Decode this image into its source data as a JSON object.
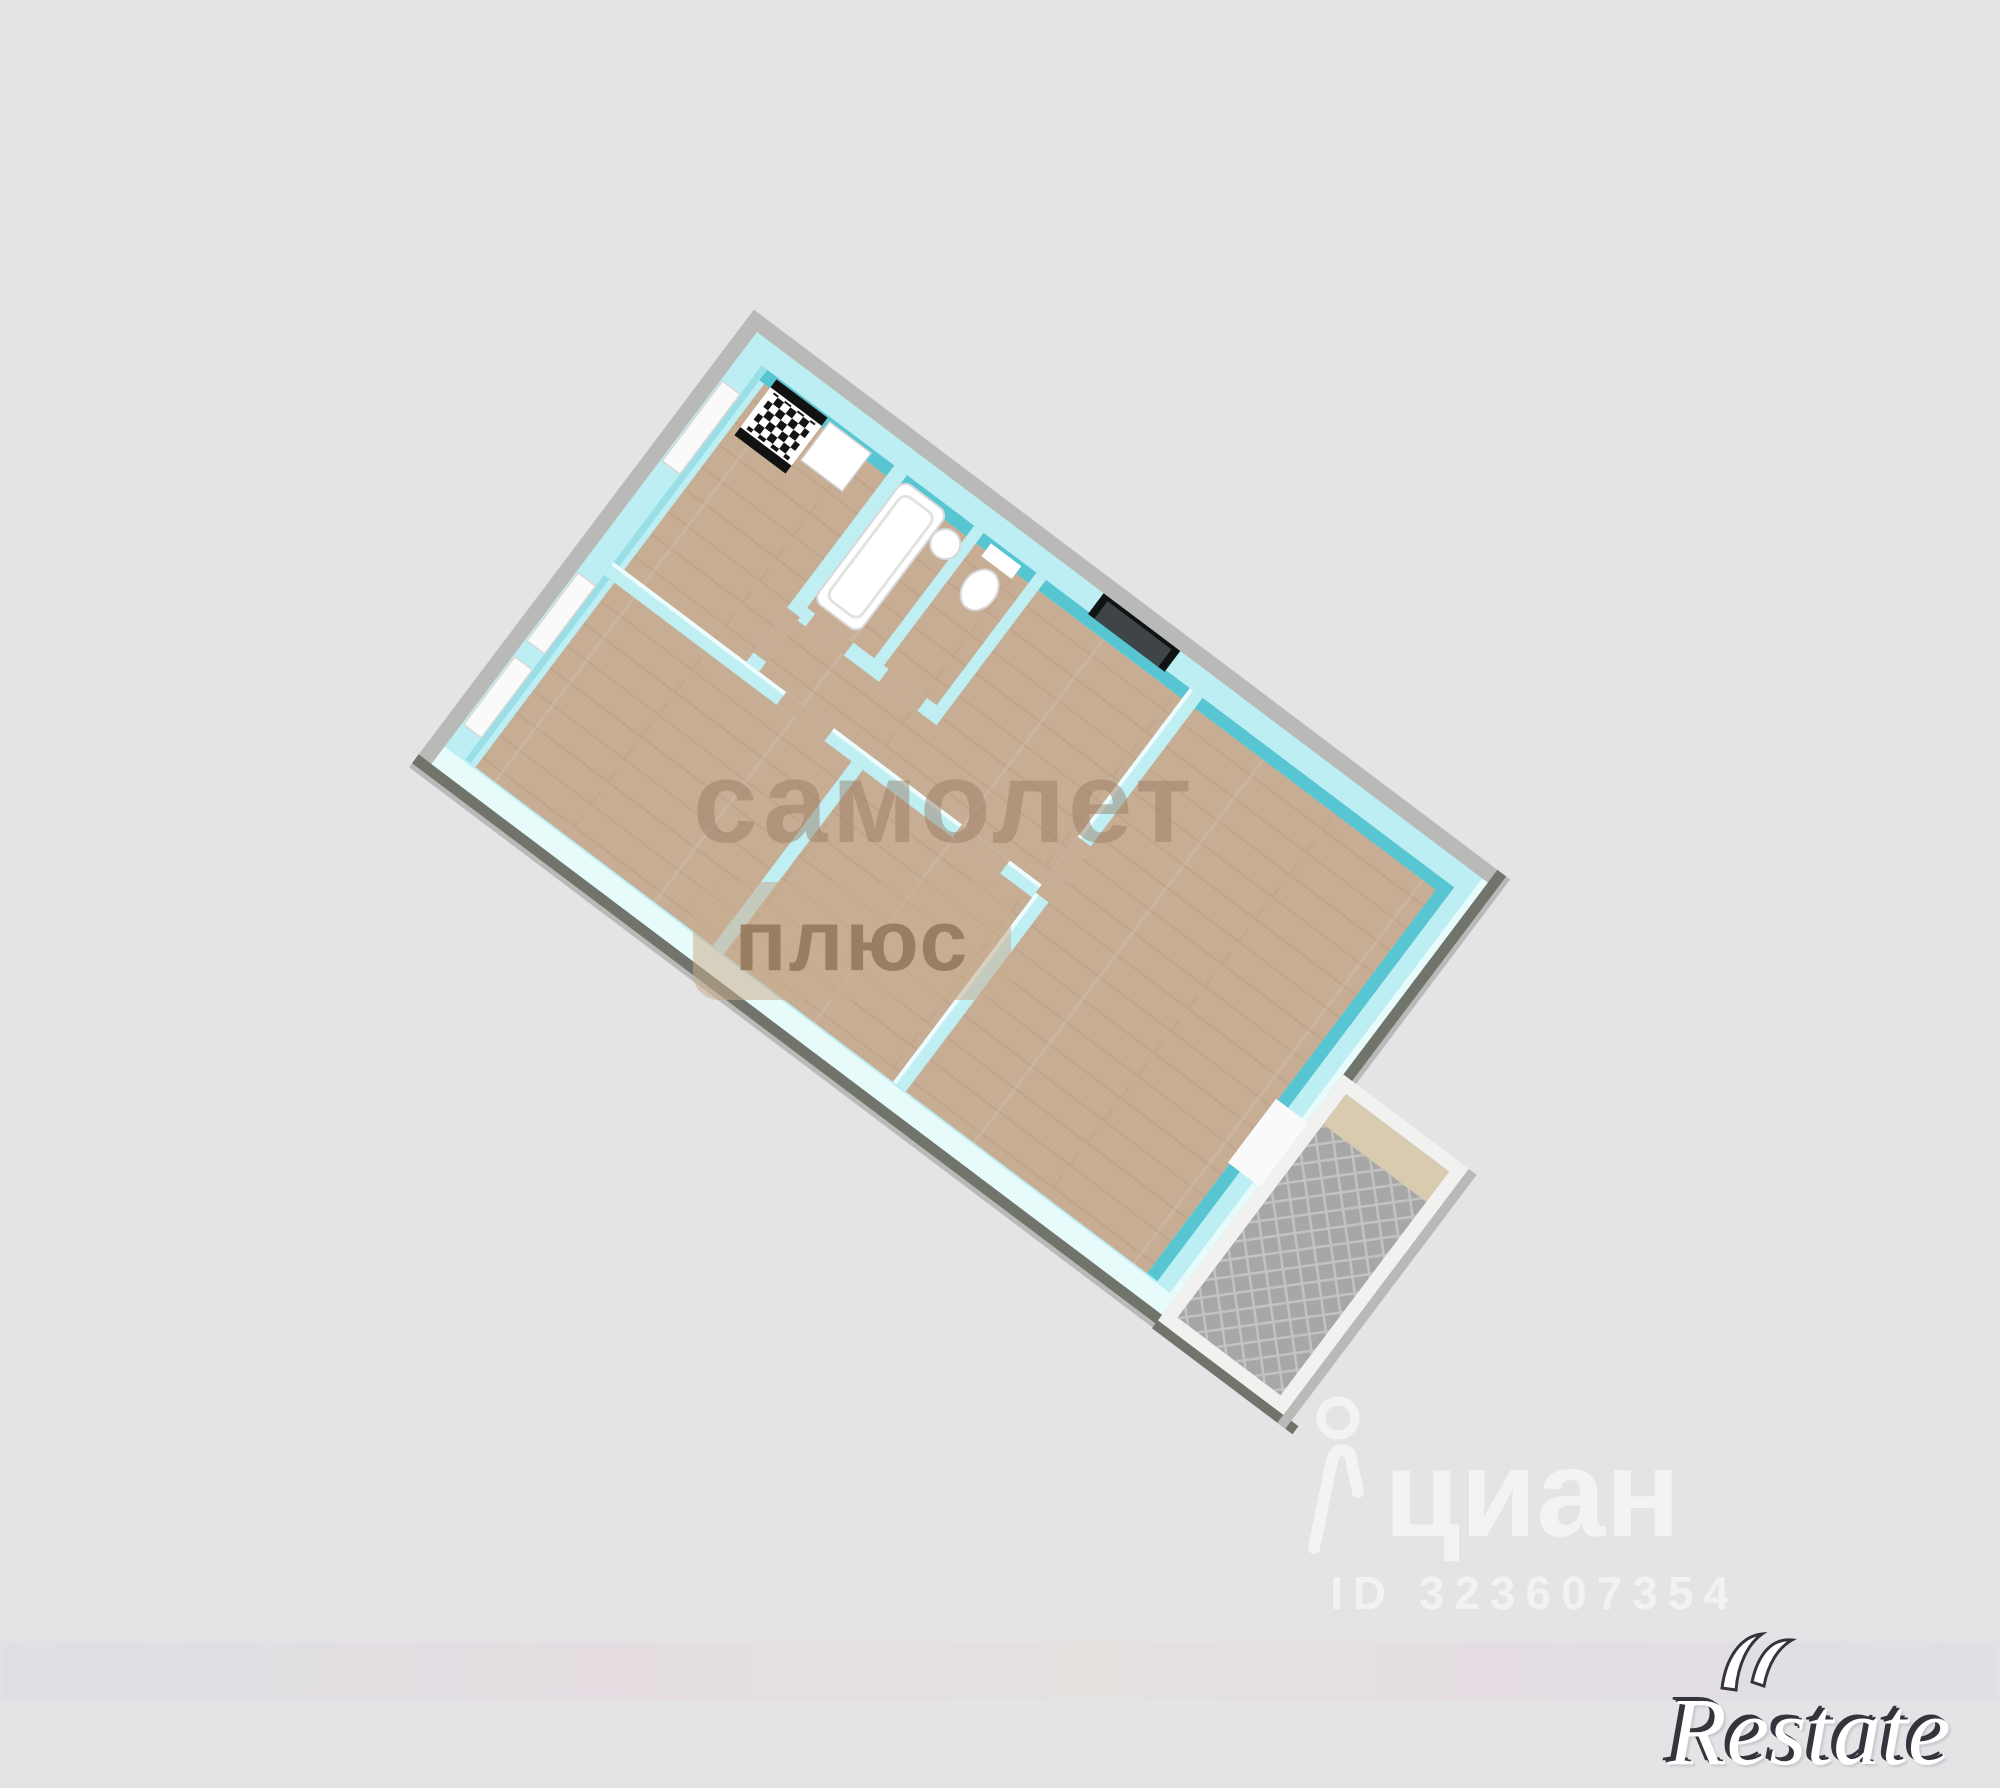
{
  "watermarks": {
    "samolet_line1": "самолет",
    "samolet_line2": "плюс",
    "cian_brand": "циан",
    "cian_id": "ID 323607354",
    "restate_text": "Restate"
  },
  "colors": {
    "background": "#e4e4e6",
    "plinth": "#b9b9b7",
    "shadow": "#70746a",
    "wall_top": "#bceef3",
    "wall_top_light": "#e8fbfb",
    "wall_inner": "#57c6d2",
    "wall_inner_soft": "#9adfe6",
    "partition": "#bfeef3",
    "partition_highlight": "#eefcfd",
    "floor": "#c6ad94",
    "window": "#fafafa",
    "entry_door": "#3e4447",
    "entry_frame": "#101314",
    "fixture": "#ffffff",
    "stove_strip": "#121212",
    "balcony_wall": "#f1f1ef",
    "balcony_floor": "#a7a7a7",
    "balcony_shelf": "#d8cbb0"
  }
}
